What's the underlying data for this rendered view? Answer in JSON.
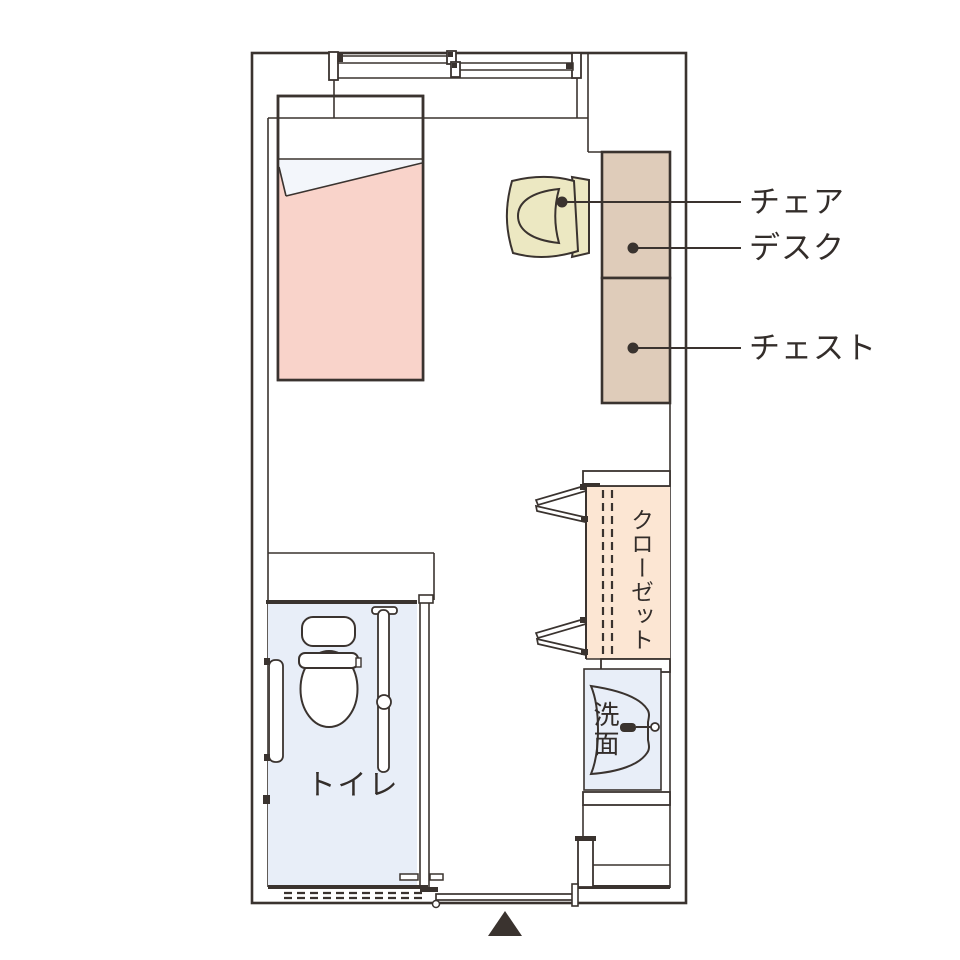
{
  "diagram": {
    "type": "room-floor-plan",
    "labels": {
      "chair": "チェア",
      "desk": "デスク",
      "chest": "チェスト",
      "closet": "クローゼット",
      "washbasin": "洗面",
      "toilet": "トイレ"
    },
    "icons": {
      "entrance_marker": "▲"
    },
    "colors": {
      "line": "#3a332f",
      "text": "#332d2a",
      "bed-pink": "#f9d3ca",
      "sheet-white": "#f3f6fb",
      "chair-cream": "#ece8c2",
      "wood-brown": "#dfccba",
      "closet-peach": "#fce6d3",
      "water-blue": "#e8eef8"
    }
  }
}
